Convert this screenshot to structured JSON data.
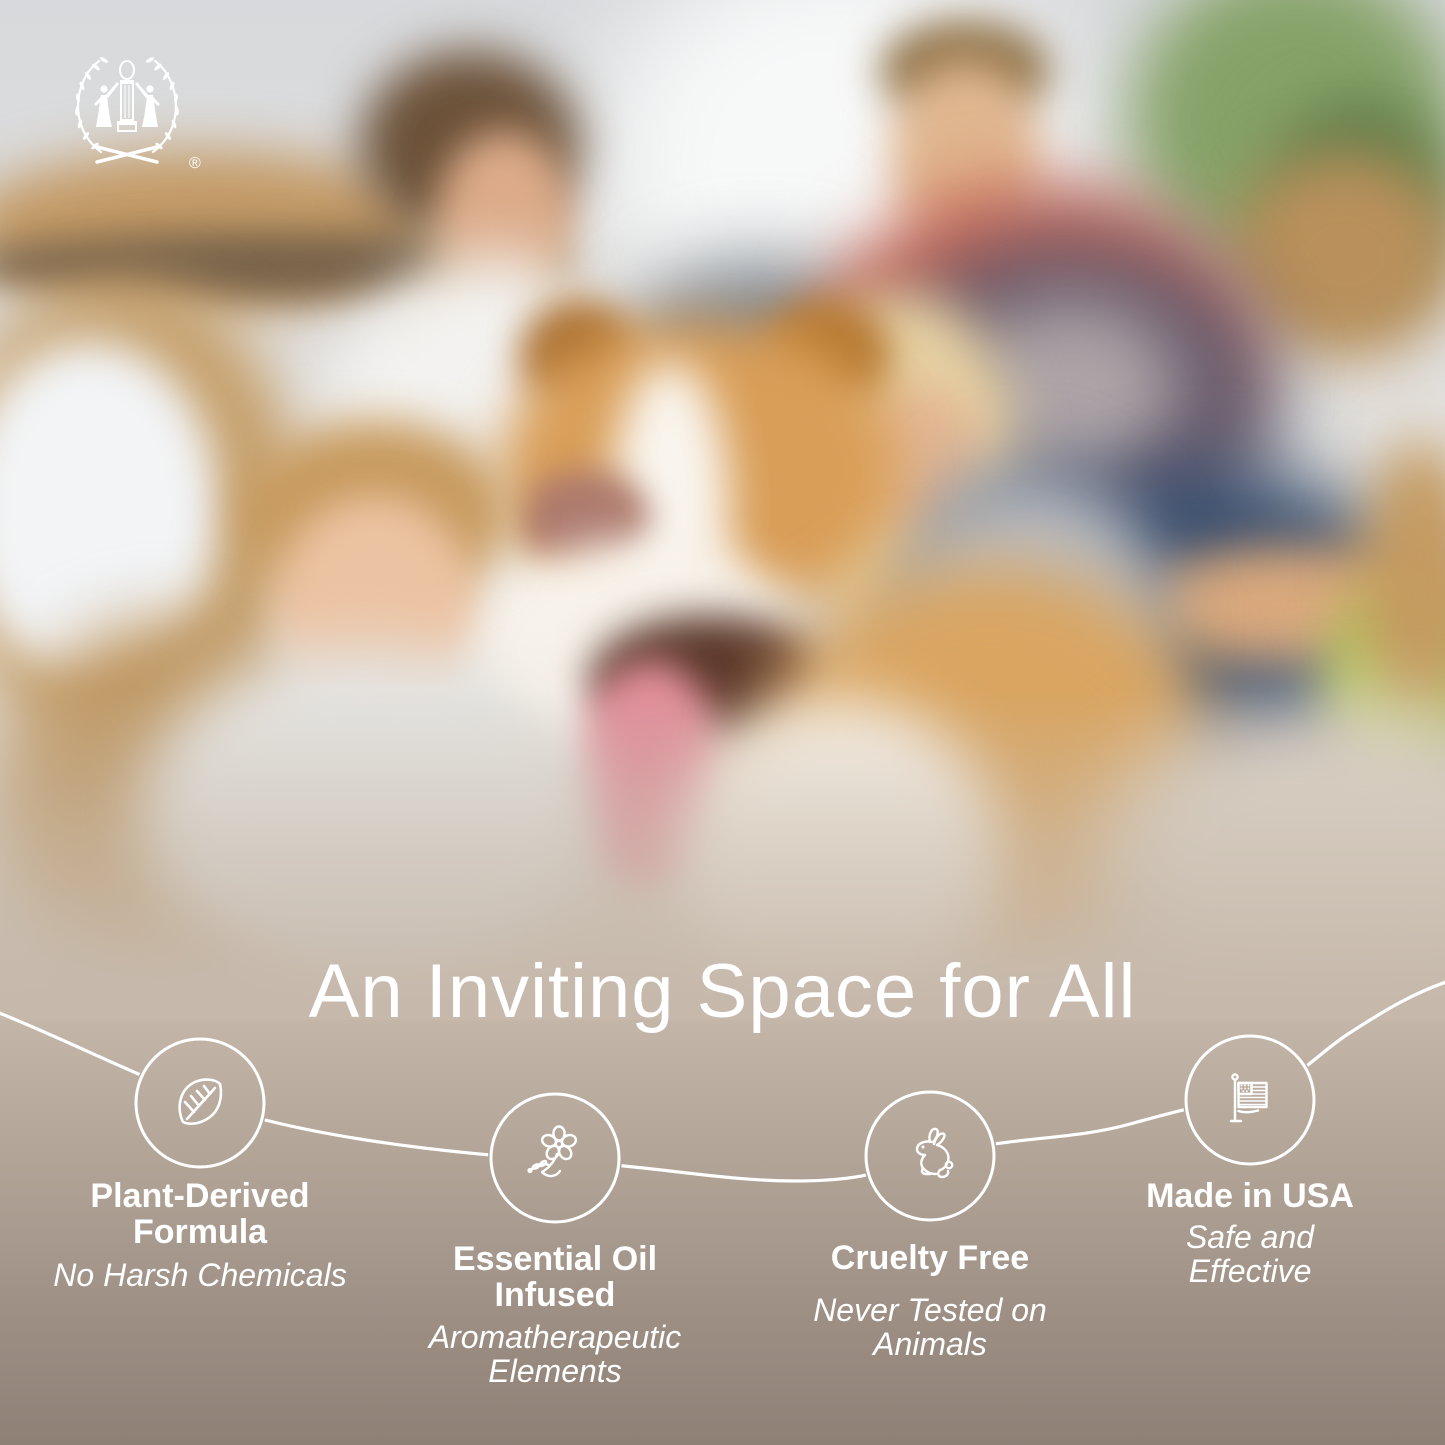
{
  "brand": {
    "logo_icon": "laurel-wreath-figures-logo",
    "registered_mark": "®"
  },
  "headline": "An Inviting Space for All",
  "features": [
    {
      "icon": "leaf-icon",
      "title": "Plant-Derived Formula",
      "subtitle": "No Harsh Chemicals"
    },
    {
      "icon": "essential-oil-flower-icon",
      "title": "Essential Oil Infused",
      "subtitle": "Aromatherapeutic Elements"
    },
    {
      "icon": "rabbit-icon",
      "title": "Cruelty Free",
      "subtitle": "Never Tested on Animals"
    },
    {
      "icon": "usa-flag-icon",
      "title": "Made in USA",
      "subtitle": "Safe and Effective"
    }
  ],
  "photo_alt": "Blurred photo of a smiling family (mother, father, boy, girl) with a brown-and-white border collie dog in a bright living room with cardboard moving boxes",
  "colors": {
    "text": "#ffffff",
    "connector_line": "#ffffff",
    "band_top": "#c4b7aa",
    "band_bottom": "#8e8075"
  }
}
